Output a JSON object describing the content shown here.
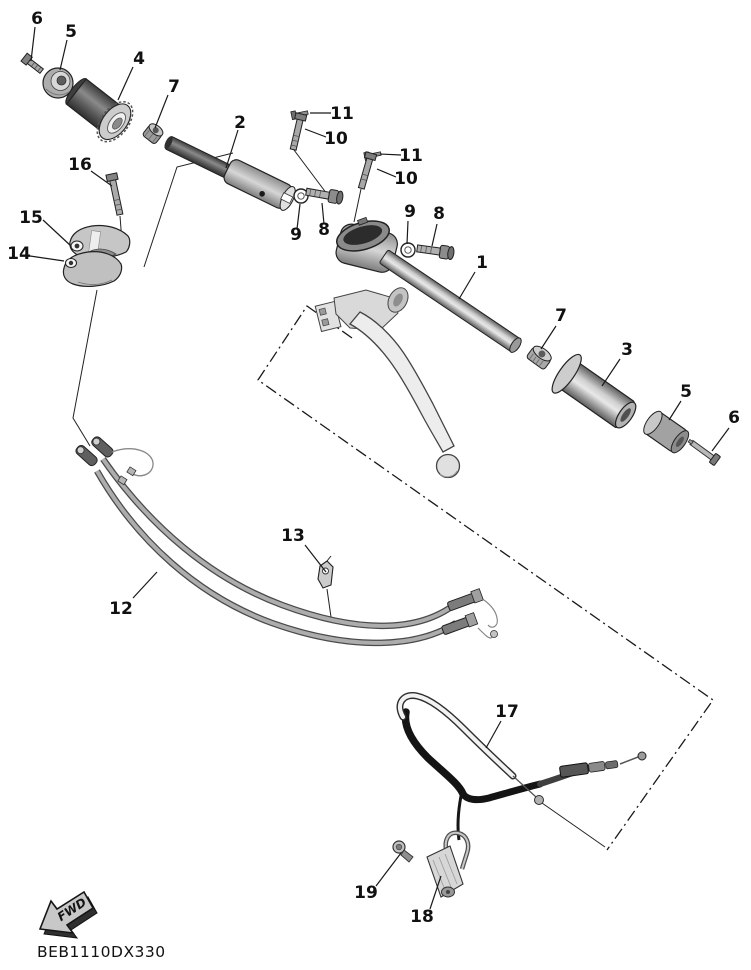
{
  "diagram": {
    "code": "BEB1110DX330",
    "fwd_label": "FWD",
    "callouts": [
      {
        "num": "6",
        "x": 37,
        "y": 24,
        "leader": [
          35,
          27,
          31,
          61
        ]
      },
      {
        "num": "5",
        "x": 71,
        "y": 37,
        "leader": [
          67,
          40,
          60,
          70
        ]
      },
      {
        "num": "4",
        "x": 139,
        "y": 64,
        "leader": [
          133,
          67,
          118,
          100
        ]
      },
      {
        "num": "7",
        "x": 174,
        "y": 92,
        "leader": [
          168,
          95,
          155,
          128
        ]
      },
      {
        "num": "2",
        "x": 240,
        "y": 128,
        "leader": [
          238,
          130,
          226,
          168
        ]
      },
      {
        "num": "11",
        "x": 342,
        "y": 119,
        "leader": [
          331,
          113,
          310,
          113
        ]
      },
      {
        "num": "10",
        "x": 336,
        "y": 144,
        "leader": [
          326,
          137,
          305,
          129
        ]
      },
      {
        "num": "16",
        "x": 80,
        "y": 170,
        "leader": [
          91,
          171,
          112,
          186
        ]
      },
      {
        "num": "15",
        "x": 31,
        "y": 223,
        "leader": [
          43,
          220,
          71,
          246
        ]
      },
      {
        "num": "14",
        "x": 19,
        "y": 259,
        "leader": [
          30,
          256,
          64,
          261
        ]
      },
      {
        "num": "9",
        "x": 296,
        "y": 240,
        "leader": [
          297,
          229,
          300,
          204
        ]
      },
      {
        "num": "8",
        "x": 324,
        "y": 235,
        "leader": [
          324,
          224,
          322,
          203
        ]
      },
      {
        "num": "11",
        "x": 411,
        "y": 161,
        "leader": [
          401,
          155,
          380,
          154
        ]
      },
      {
        "num": "10",
        "x": 406,
        "y": 184,
        "leader": [
          396,
          177,
          377,
          169
        ]
      },
      {
        "num": "9",
        "x": 410,
        "y": 217,
        "leader": [
          408,
          221,
          407,
          244
        ]
      },
      {
        "num": "8",
        "x": 439,
        "y": 219,
        "leader": [
          437,
          224,
          432,
          246
        ]
      },
      {
        "num": "1",
        "x": 482,
        "y": 268,
        "leader": [
          475,
          272,
          459,
          299
        ]
      },
      {
        "num": "7",
        "x": 561,
        "y": 321,
        "leader": [
          556,
          326,
          541,
          349
        ]
      },
      {
        "num": "3",
        "x": 627,
        "y": 355,
        "leader": [
          620,
          359,
          602,
          386
        ]
      },
      {
        "num": "5",
        "x": 686,
        "y": 397,
        "leader": [
          681,
          401,
          669,
          420
        ]
      },
      {
        "num": "6",
        "x": 734,
        "y": 423,
        "leader": [
          729,
          428,
          712,
          451
        ]
      },
      {
        "num": "13",
        "x": 293,
        "y": 541,
        "leader": [
          305,
          545,
          326,
          572
        ]
      },
      {
        "num": "12",
        "x": 121,
        "y": 614,
        "leader": [
          133,
          598,
          157,
          572
        ]
      },
      {
        "num": "17",
        "x": 507,
        "y": 717,
        "leader": [
          501,
          721,
          486,
          748
        ]
      },
      {
        "num": "19",
        "x": 366,
        "y": 898,
        "leader": [
          376,
          886,
          401,
          853
        ]
      },
      {
        "num": "18",
        "x": 422,
        "y": 922,
        "leader": [
          430,
          909,
          441,
          876
        ]
      }
    ],
    "assembly_box_points": "352,338 307,306 258,380 713,700 607,850",
    "aux_leaders": [
      "294,150 327,194",
      "361,189 354,222",
      "120,216 122,242",
      "233,153 177,167 144,267",
      "97,290 73,418 90,446",
      "327,589 331,617",
      "542,803 605,847"
    ]
  }
}
